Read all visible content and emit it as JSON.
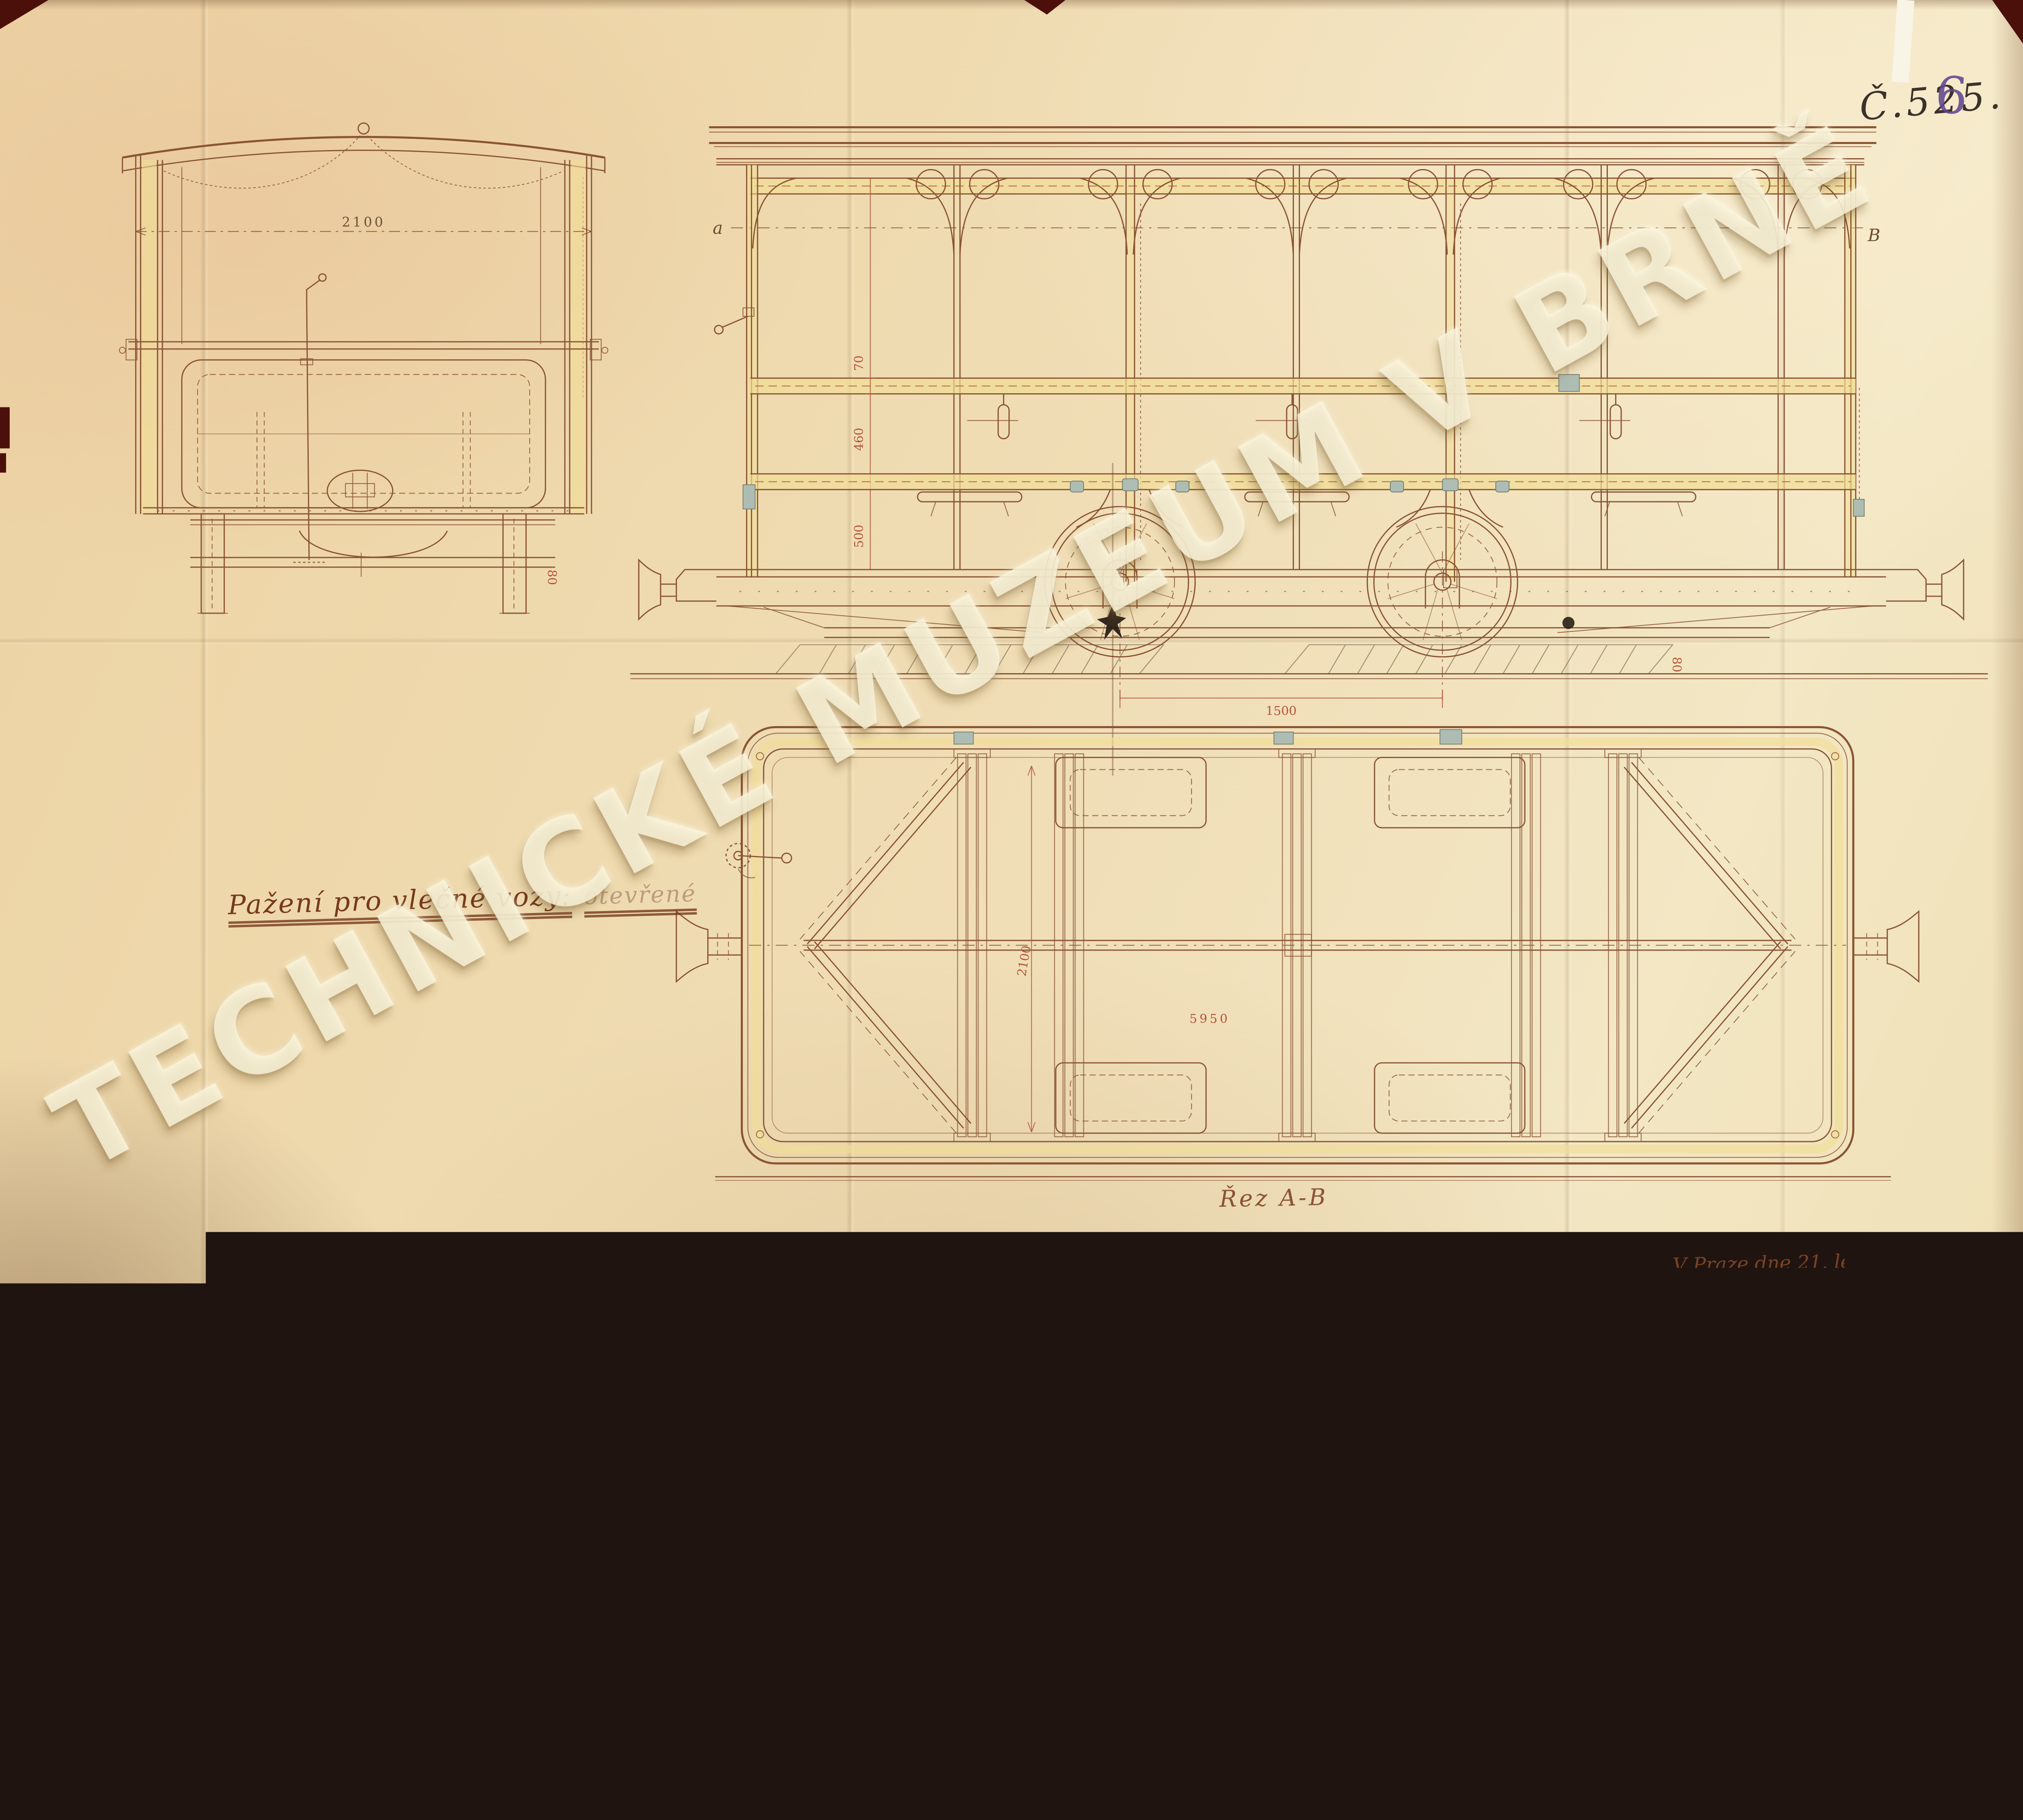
{
  "document": {
    "kind": "scanned technical drawing (tram trailer car), Technical Museum Brno archive",
    "drawing_number": "Č.525.",
    "drawing_number_overwrite": "6",
    "title": "Pažení pro vlečné vozy:",
    "title_annotation": "otevřené",
    "section_caption": "Řez A-B",
    "place_and_date": "V Praze dne 21. ledna 1911.",
    "watermark": "TECHNICKÉ MUZEUM V BRNĚ"
  },
  "markers": {
    "left": "a",
    "right": "B"
  },
  "dimensions": {
    "end_view_width": "2100",
    "wheelbase": "1500",
    "plan_length": "5950",
    "plan_width": "2100",
    "height_steps": [
      "70",
      "460",
      "500"
    ],
    "small_offset": "80"
  },
  "colors": {
    "paper": "#eed9ad",
    "paper_light": "#f4e8c6",
    "line_brown": "#8a5434",
    "dimension_red": "#b3543a",
    "highlight_yellow": "#f1dd96",
    "fitting_gray": "#aebdb3",
    "ink_black": "#3b332a",
    "ink_purple": "#6b5191",
    "watermark_cream": "#faf4da",
    "backing_dark": "#4c100b"
  }
}
